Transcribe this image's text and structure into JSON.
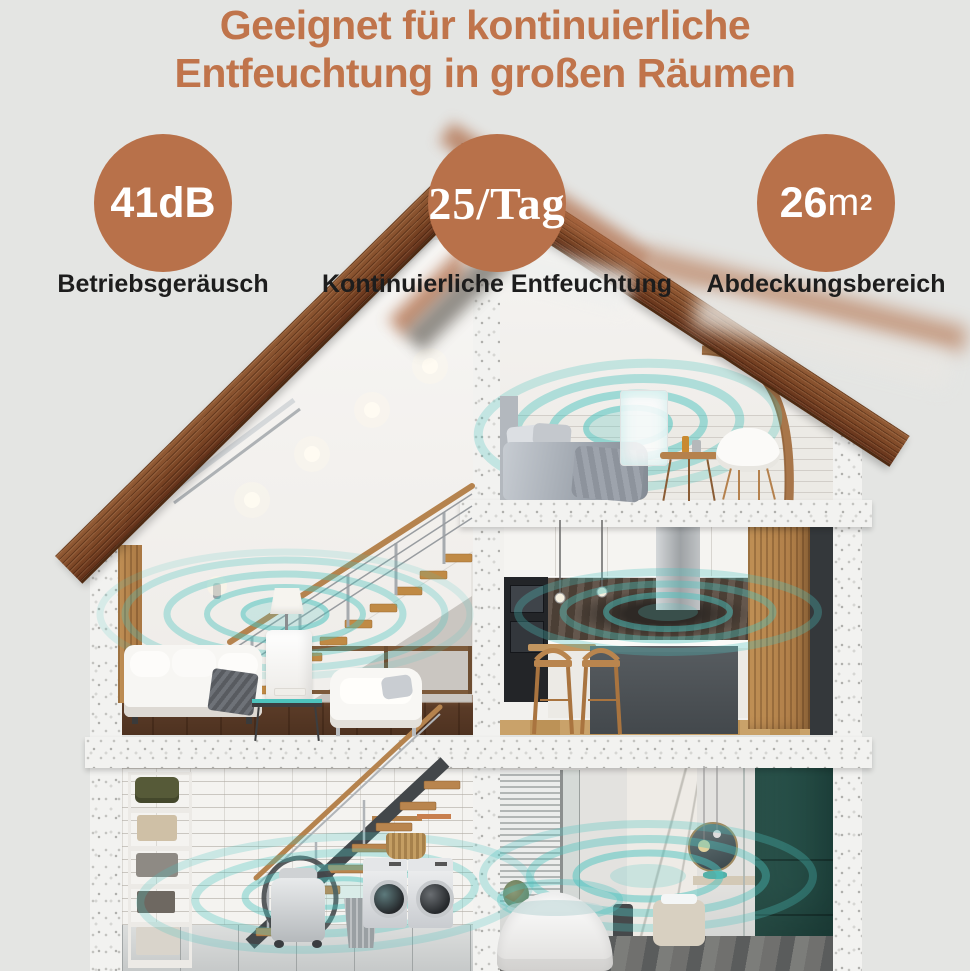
{
  "title": {
    "line1": "Geeignet für kontinuierliche",
    "line2": "Entfeuchtung in großen Räumen"
  },
  "stats": [
    {
      "value": "41dB",
      "unit": "",
      "sup": "",
      "label": "Betriebsgeräusch"
    },
    {
      "value": "25/Tag",
      "unit": "",
      "sup": "",
      "label": "Kontinuierliche Entfeuchtung"
    },
    {
      "value": "26",
      "unit": "m",
      "sup": "2",
      "label": "Abdeckungsbereich"
    }
  ],
  "colors": {
    "background": "#e4e5e3",
    "title_copper": "#c0744b",
    "badge_copper": "#b8714a",
    "ripple_teal": "#4cc4bf",
    "roof_brown": "#7a4424",
    "label_black": "#1d1d1d"
  }
}
